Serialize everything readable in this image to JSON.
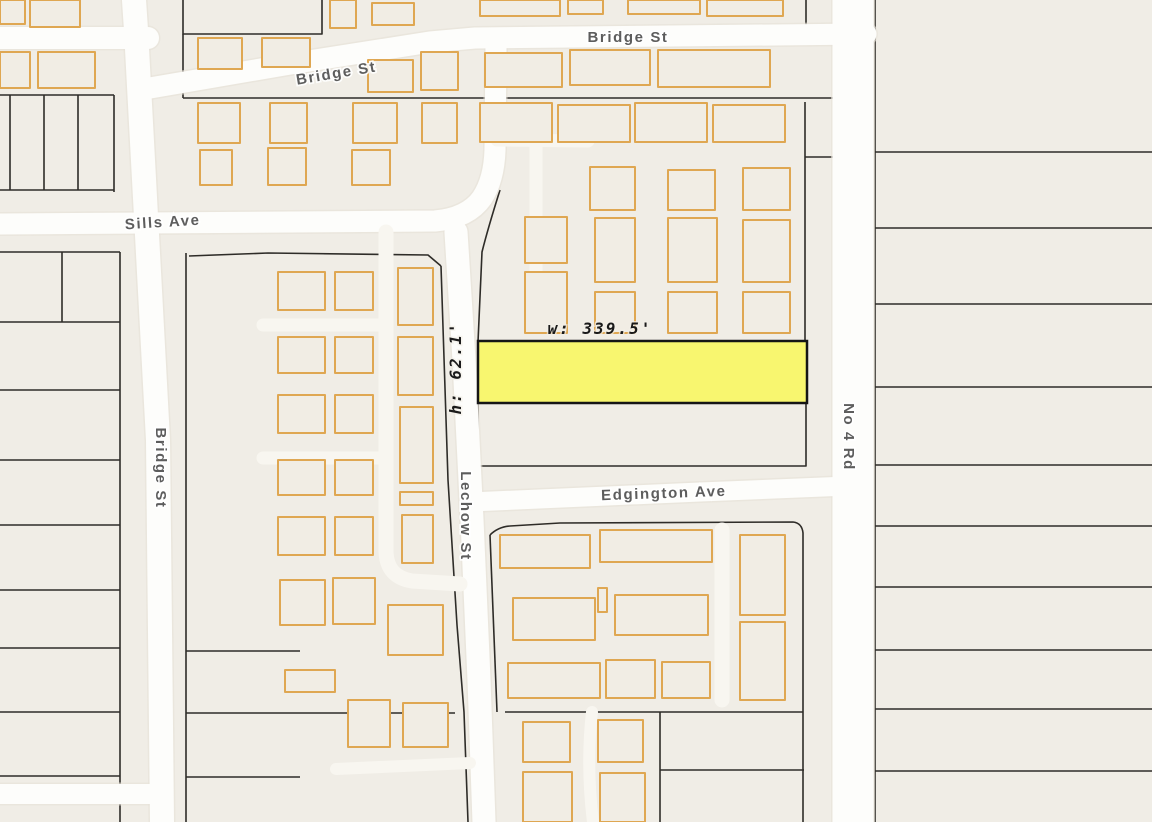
{
  "map": {
    "streets": {
      "bridge_top": "Bridge St",
      "bridge_diag": "Bridge St",
      "bridge_left": "Bridge St",
      "sills": "Sills Ave",
      "lechow": "Lechow St",
      "edgington": "Edgington Ave",
      "no4": "No 4 Rd"
    },
    "highlight": {
      "width_label": "w: 339.5'",
      "height_label": "h: 62.1'",
      "fill": "#f8f66f",
      "stroke": "#151515",
      "x": 478,
      "y": 341,
      "w": 329,
      "h": 62
    },
    "colors": {
      "background": "#f0ede6",
      "road": "#fdfdfb",
      "road_casing": "#e6e2d9",
      "lane": "#f8f6f0",
      "building_fill": "#f1ede4",
      "building_stroke": "#dfa752",
      "parcel_line": "#2e2c28",
      "label": "#5d5d5d",
      "dimension_text": "#1a1a1a"
    },
    "roads": [
      {
        "name": "bridge-st-top-left",
        "d": "M 0 38 H 148",
        "w": 22
      },
      {
        "name": "bridge-st-top",
        "d": "M 150 88 L 290 64 L 430 42 L 475 38 L 866 34",
        "w": 21
      },
      {
        "name": "bridge-st-west",
        "d": "M 134 0 L 136 30 L 158 440 L 162 822",
        "w": 24
      },
      {
        "name": "sills-ave",
        "d": "M 0 224 L 435 221 Q 468 218 482 198 Q 494 180 495 150 L 496 46",
        "w": 21
      },
      {
        "name": "lechow-st",
        "d": "M 456 232 L 464 360 L 472 520 L 479 680 L 484 822",
        "w": 23
      },
      {
        "name": "edgington-ave",
        "d": "M 470 502 L 700 492 L 848 486",
        "w": 19
      },
      {
        "name": "no-4-rd",
        "d": "M 853 0 V 822",
        "w": 41
      },
      {
        "name": "bottom-left-road",
        "d": "M 0 794 H 150",
        "w": 20
      },
      {
        "name": "block-lane-vertical",
        "d": "M 386 232 L 386 552 Q 387 577 412 581 L 460 584",
        "w": 15,
        "lane": true
      },
      {
        "name": "block-lane-stub-1",
        "d": "M 384 325 H 263",
        "w": 13,
        "lane": true
      },
      {
        "name": "block-lane-stub-2",
        "d": "M 384 458 H 263",
        "w": 13,
        "lane": true
      },
      {
        "name": "block-lane-south",
        "d": "M 336 769 L 470 763",
        "w": 12,
        "lane": true
      },
      {
        "name": "court-lane-h",
        "d": "M 497 140 L 588 141",
        "w": 13,
        "lane": true
      },
      {
        "name": "court-lane-v",
        "d": "M 536 141 V 308",
        "w": 13,
        "lane": true
      },
      {
        "name": "edgington-block-lane",
        "d": "M 722 530 V 700",
        "w": 15,
        "lane": true
      },
      {
        "name": "south-block-lane",
        "d": "M 592 712 Q 586 765 593 822",
        "w": 12,
        "lane": true
      }
    ],
    "parcel_lines": [
      "M 0 95 H 114",
      "M 10 95 V 190",
      "M 44 95 V 190",
      "M 78 95 V 190",
      "M 114 95 V 192",
      "M 0 190 H 114",
      "M 120 252 V 822",
      "M 0 252 H 120",
      "M 0 322 H 120",
      "M 0 390 H 120",
      "M 0 460 H 120",
      "M 0 525 H 120",
      "M 0 590 H 120",
      "M 0 648 H 120",
      "M 0 712 H 120",
      "M 0 776 H 120",
      "M 62 252 V 322",
      "M 186 253 V 822",
      "M 186 651 H 300",
      "M 186 713 H 455",
      "M 186 777 H 300",
      "M 189 256 L 268 253 L 428 255 L 441 266",
      "M 441 266 L 448 480 L 457 625 L 464 712 L 468 822",
      "M 183 0 V 34 H 322 V 0",
      "M 183 34 V 98",
      "M 183 98 H 868",
      "M 806 0 V 33",
      "M 500 190 Q 488 228 482 252 L 478 342",
      "M 805 102 V 340",
      "M 805 157 H 833",
      "M 478 404 V 466 H 806 V 404",
      "M 490 535 Q 498 527 510 526 L 560 523 L 793 522 Q 802 523 803 533 V 712",
      "M 490 535 L 497 712",
      "M 505 712 H 803",
      "M 660 712 V 822",
      "M 660 770 H 804",
      "M 803 712 V 822",
      "M 875 0 V 822",
      "M 875 152 H 1152",
      "M 875 228 H 1152",
      "M 875 304 H 1152",
      "M 875 387 H 1152",
      "M 875 465 H 1152",
      "M 875 526 H 1152",
      "M 875 587 H 1152",
      "M 875 650 H 1152",
      "M 875 709 H 1152",
      "M 875 771 H 1152"
    ],
    "buildings": [
      [
        30,
        0,
        50,
        27
      ],
      [
        0,
        0,
        25,
        24
      ],
      [
        330,
        0,
        26,
        28
      ],
      [
        372,
        3,
        42,
        22
      ],
      [
        480,
        0,
        80,
        16
      ],
      [
        568,
        0,
        35,
        14
      ],
      [
        628,
        0,
        72,
        14
      ],
      [
        707,
        0,
        76,
        16
      ],
      [
        0,
        52,
        30,
        36
      ],
      [
        38,
        52,
        57,
        36
      ],
      [
        198,
        38,
        44,
        31
      ],
      [
        262,
        38,
        48,
        29
      ],
      [
        368,
        60,
        45,
        32
      ],
      [
        421,
        52,
        37,
        38
      ],
      [
        485,
        53,
        77,
        34
      ],
      [
        570,
        50,
        80,
        35
      ],
      [
        658,
        50,
        112,
        37
      ],
      [
        198,
        103,
        42,
        40
      ],
      [
        270,
        103,
        37,
        40
      ],
      [
        353,
        103,
        44,
        40
      ],
      [
        422,
        103,
        35,
        40
      ],
      [
        200,
        150,
        32,
        35
      ],
      [
        268,
        148,
        38,
        37
      ],
      [
        352,
        150,
        38,
        35
      ],
      [
        480,
        103,
        72,
        39
      ],
      [
        558,
        105,
        72,
        37
      ],
      [
        635,
        103,
        72,
        39
      ],
      [
        713,
        105,
        72,
        37
      ],
      [
        590,
        167,
        45,
        43
      ],
      [
        668,
        170,
        47,
        40
      ],
      [
        743,
        168,
        47,
        42
      ],
      [
        525,
        217,
        42,
        46
      ],
      [
        595,
        218,
        40,
        64
      ],
      [
        668,
        218,
        49,
        64
      ],
      [
        743,
        220,
        47,
        62
      ],
      [
        525,
        272,
        42,
        61
      ],
      [
        595,
        292,
        40,
        41
      ],
      [
        668,
        292,
        49,
        41
      ],
      [
        743,
        292,
        47,
        41
      ],
      [
        278,
        272,
        47,
        38
      ],
      [
        335,
        272,
        38,
        38
      ],
      [
        278,
        337,
        47,
        36
      ],
      [
        335,
        337,
        38,
        36
      ],
      [
        278,
        395,
        47,
        38
      ],
      [
        335,
        395,
        38,
        38
      ],
      [
        278,
        460,
        47,
        35
      ],
      [
        335,
        460,
        38,
        35
      ],
      [
        278,
        517,
        47,
        38
      ],
      [
        335,
        517,
        38,
        38
      ],
      [
        398,
        268,
        35,
        57
      ],
      [
        398,
        337,
        35,
        58
      ],
      [
        400,
        407,
        33,
        76
      ],
      [
        400,
        492,
        33,
        13
      ],
      [
        402,
        515,
        31,
        48
      ],
      [
        280,
        580,
        45,
        45
      ],
      [
        333,
        578,
        42,
        46
      ],
      [
        388,
        605,
        55,
        50
      ],
      [
        285,
        670,
        50,
        22
      ],
      [
        348,
        700,
        42,
        47
      ],
      [
        403,
        703,
        45,
        44
      ],
      [
        500,
        535,
        90,
        33
      ],
      [
        600,
        530,
        112,
        32
      ],
      [
        513,
        598,
        82,
        42
      ],
      [
        598,
        588,
        9,
        24
      ],
      [
        615,
        595,
        93,
        40
      ],
      [
        508,
        663,
        92,
        35
      ],
      [
        606,
        660,
        49,
        38
      ],
      [
        662,
        662,
        48,
        36
      ],
      [
        740,
        535,
        45,
        80
      ],
      [
        740,
        622,
        45,
        78
      ],
      [
        523,
        722,
        47,
        40
      ],
      [
        598,
        720,
        45,
        42
      ],
      [
        523,
        772,
        49,
        50
      ],
      [
        600,
        773,
        45,
        49
      ]
    ]
  }
}
